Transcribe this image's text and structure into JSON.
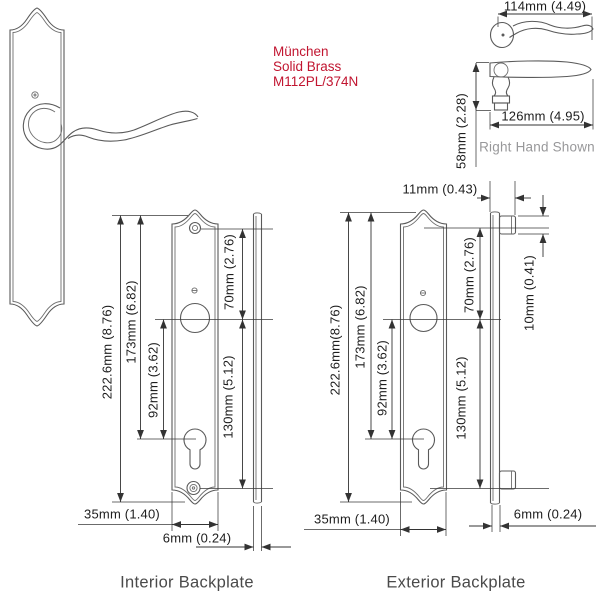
{
  "product": {
    "name": "München",
    "material": "Solid Brass",
    "model": "M112PL/374N"
  },
  "handle": {
    "top_width": "114mm (4.49)",
    "length": "126mm (4.95)",
    "height": "58mm (2.28)",
    "note": "Right Hand Shown"
  },
  "interior": {
    "caption": "Interior Backplate",
    "overall_height": "222.6mm (8.76)",
    "top_to_cylinder": "173mm (6.82)",
    "hub_to_cylinder": "92mm (3.62)",
    "screw_to_hub": "70mm (2.76)",
    "hub_to_bottom_screw": "130mm (5.12)",
    "width": "35mm (1.40)",
    "thickness": "6mm (0.24)"
  },
  "exterior": {
    "caption": "Exterior Backplate",
    "boss_projection": "11mm (0.43)",
    "overall_height": "222.6mm(8.76)",
    "top_to_cylinder": "173mm (6.82)",
    "hub_to_cylinder": "92mm (3.62)",
    "screw_to_hub": "70mm (2.76)",
    "hub_to_bottom_screw": "130mm (5.12)",
    "boss_height": "10mm (0.41)",
    "width": "35mm (1.40)",
    "thickness": "6mm (0.24)"
  },
  "colors": {
    "accent_red": "#c11530",
    "drawing_line": "#5a5a5a",
    "dimension_line": "#333333",
    "note_gray": "#98989a",
    "caption_gray": "#4a4a4a"
  }
}
